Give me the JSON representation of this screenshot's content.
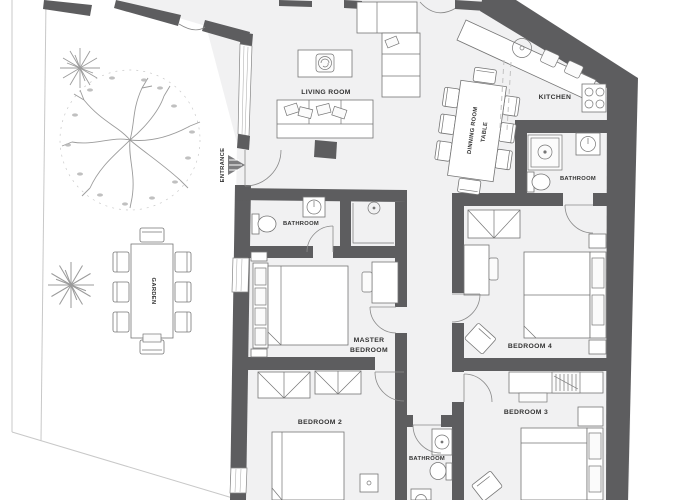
{
  "plan": {
    "labels": {
      "living_room": "LIVING ROOM",
      "kitchen": "KITCHEN",
      "dining_line1": "DINNING ROOM",
      "dining_line2": "TABLE",
      "bath_kitchen": "BATHROOM",
      "bath_master": "BATHROOM",
      "bath_hall": "BATHROOM",
      "master_line1": "MASTER",
      "master_line2": "BEDROOM",
      "bedroom2": "BEDROOM 2",
      "bedroom3": "BEDROOM 3",
      "bedroom4": "BEDROOM 4",
      "garden": "GARDEN",
      "entrance": "ENTRANCE"
    },
    "colors": {
      "wall": "#5d5d5f",
      "floor": "#f1f1f2",
      "furn_stroke": "#757575",
      "garden_line": "#9b9b9b",
      "text": "#333333",
      "boundary": "#c8c8c8",
      "background": "#ffffff"
    }
  }
}
